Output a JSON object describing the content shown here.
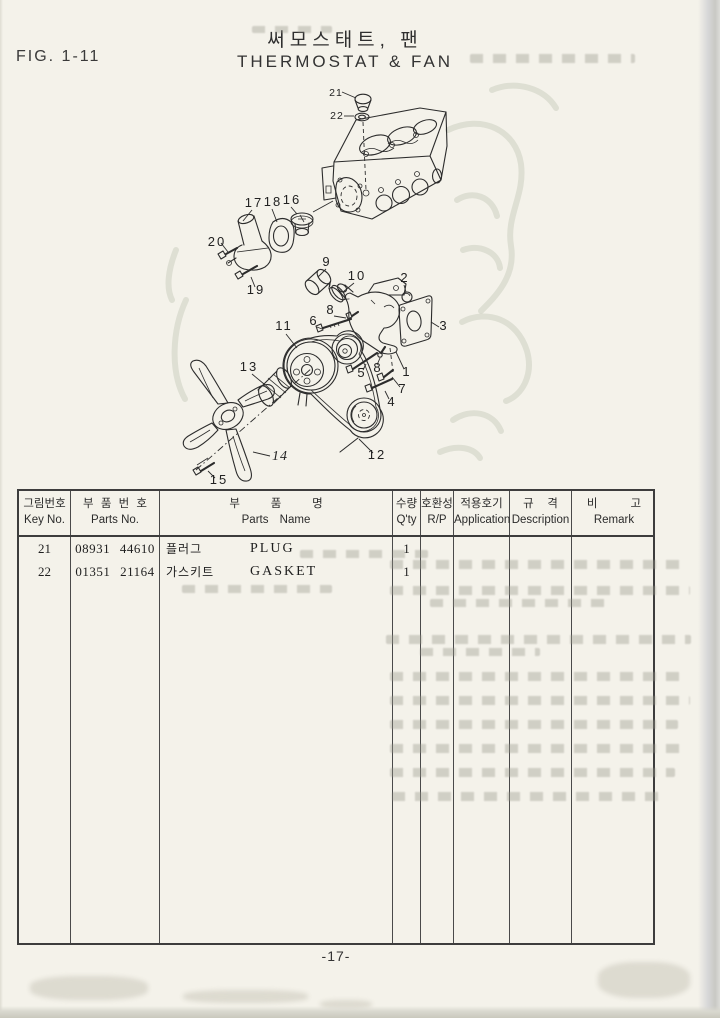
{
  "page": {
    "fig_label": "FIG. 1-11",
    "title_kr": "써모스태트, 팬",
    "title_en": "THERMOSTAT & FAN",
    "page_number": "-17-"
  },
  "table": {
    "columns": [
      {
        "kr": "그림번호",
        "en": "Key No."
      },
      {
        "kr": "부 품 번 호",
        "en": "Parts No."
      },
      {
        "kr": "부 품 명",
        "en": "Parts Name"
      },
      {
        "kr": "수량",
        "en": "Q'ty"
      },
      {
        "kr": "호환성",
        "en": "R/P"
      },
      {
        "kr": "적용호기",
        "en": "Application"
      },
      {
        "kr": "규 격",
        "en": "Description"
      },
      {
        "kr": "비 고",
        "en": "Remark"
      }
    ],
    "rows": [
      {
        "key": "21",
        "parts_no": "08931 44610",
        "name_kr": "플러그",
        "name_en": "PLUG",
        "qty": "1"
      },
      {
        "key": "22",
        "parts_no": "01351 21164",
        "name_kr": "가스키트",
        "name_en": "GASKET",
        "qty": "1"
      }
    ]
  },
  "diagram": {
    "callouts": [
      {
        "n": "21"
      },
      {
        "n": "22"
      },
      {
        "n": "17"
      },
      {
        "n": "18"
      },
      {
        "n": "16"
      },
      {
        "n": "20"
      },
      {
        "n": "19"
      },
      {
        "n": "9"
      },
      {
        "n": "10"
      },
      {
        "n": "2"
      },
      {
        "n": "8"
      },
      {
        "n": "6"
      },
      {
        "n": "11"
      },
      {
        "n": "3"
      },
      {
        "n": "5"
      },
      {
        "n": "8"
      },
      {
        "n": "1"
      },
      {
        "n": "7"
      },
      {
        "n": "4"
      },
      {
        "n": "13"
      },
      {
        "n": "14"
      },
      {
        "n": "15"
      },
      {
        "n": "12"
      }
    ]
  }
}
